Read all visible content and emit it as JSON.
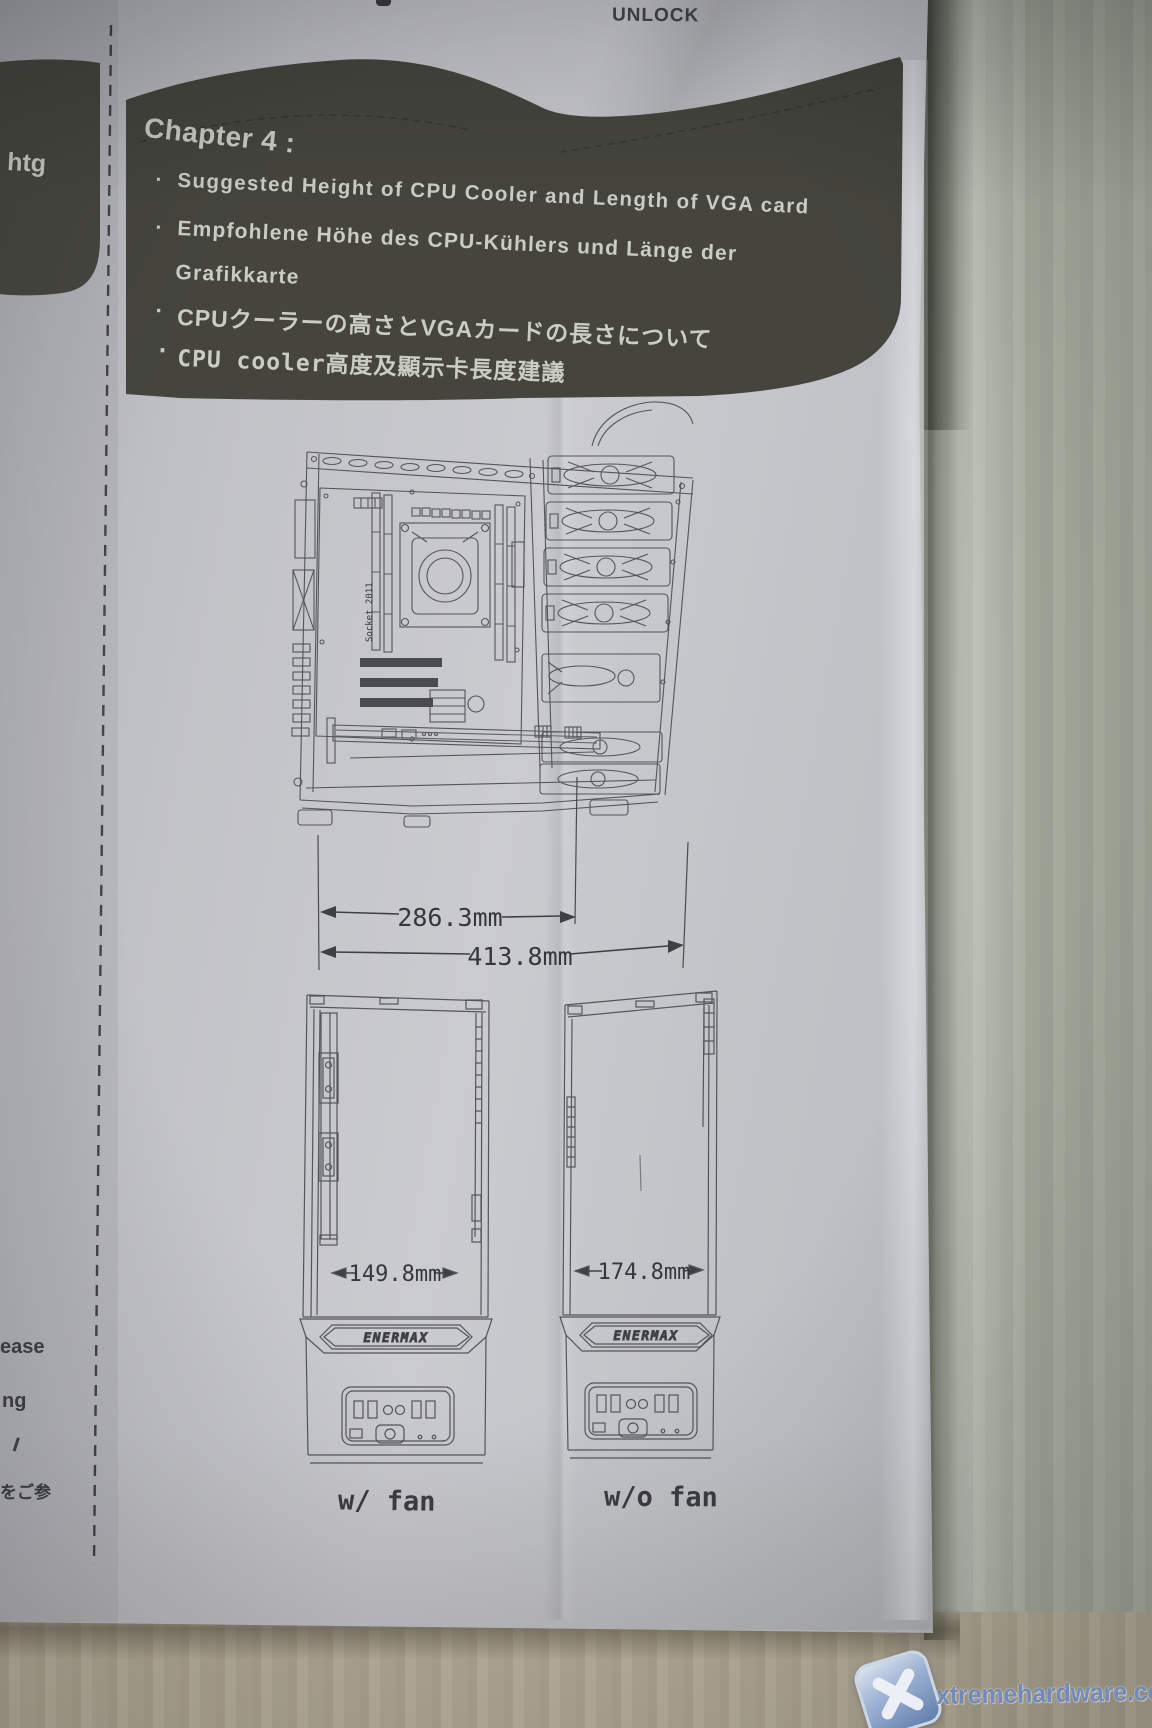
{
  "photo": {
    "unlock_label": "UNLOCK",
    "watermark": "xtremehardware.com"
  },
  "chapter": {
    "title": "Chapter 4 :",
    "left_fold_fragment": "htg",
    "lines": [
      {
        "bullet": "·",
        "text": "Suggested Height of CPU Cooler and Length of VGA card"
      },
      {
        "bullet": "·",
        "text": "Empfohlene Höhe des CPU-Kühlers und Länge der"
      },
      {
        "bullet": "",
        "text": "Grafikkarte"
      },
      {
        "bullet": "·",
        "text": "CPUクーラーの高さとVGAカードの長さについて"
      },
      {
        "bullet": "·",
        "text": "CPU cooler高度及顯示卡長度建議"
      }
    ]
  },
  "case_diagram": {
    "socket_label": "Socket 2011",
    "dim_inner": "286.3mm",
    "dim_full": "413.8mm"
  },
  "towers": {
    "brand": "ENERMAX",
    "with_fan": {
      "dim": "149.8mm",
      "label": "w/ fan"
    },
    "without_fan": {
      "dim": "174.8mm",
      "label": "w/o fan"
    }
  },
  "margin_fragments": [
    "ease",
    "ng",
    "をご参"
  ]
}
